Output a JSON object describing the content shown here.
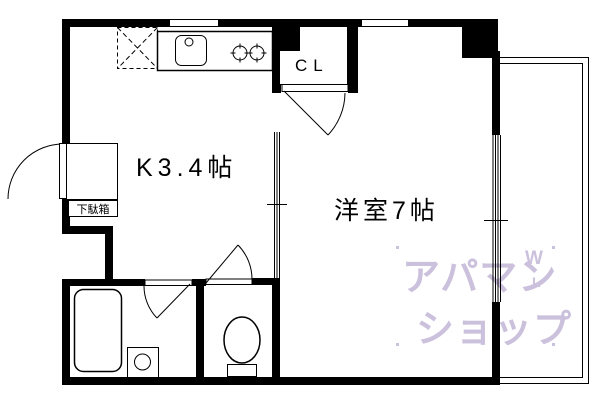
{
  "floorplan": {
    "labels": {
      "kitchen": "K3.4帖",
      "main_room": "洋室7帖",
      "closet": "CL",
      "shoe_cabinet": "下駄箱"
    },
    "watermark": {
      "line1": "アパマン",
      "line2": "ショップ",
      "mark_top": "W",
      "mark_bottom": "L",
      "color": "#cbc1dc"
    },
    "colors": {
      "wall": "#000000",
      "background": "#ffffff"
    }
  }
}
